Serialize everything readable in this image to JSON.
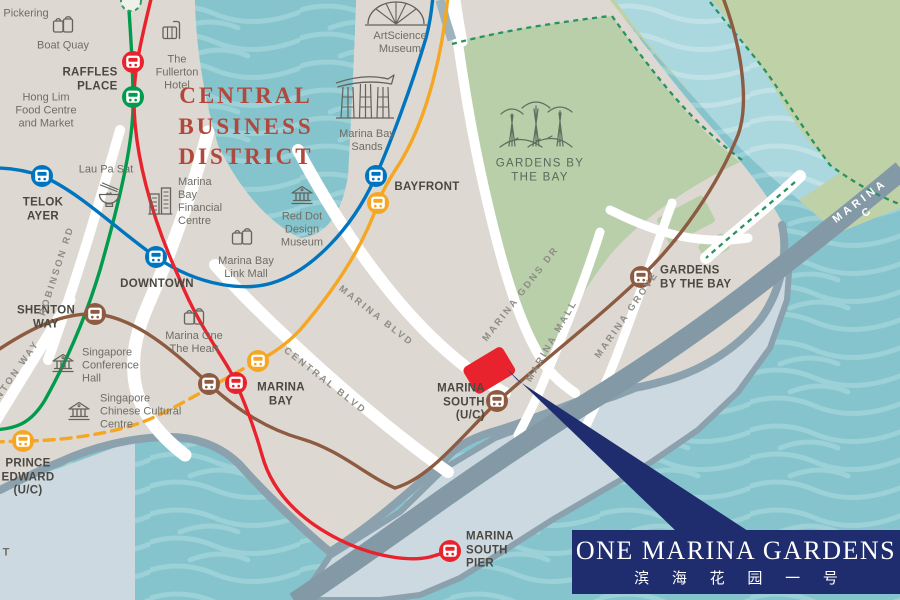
{
  "title": "One Marina Gardens location map",
  "labels": {
    "pickering": "Pickering",
    "boat_quay": "Boat Quay",
    "fullerton": "The\nFullerton\nHotel",
    "hong_lim": "Hong Lim\nFood Centre\nand Market",
    "lau_pa_sat": "Lau Pa Sat",
    "mbfc": "Marina\nBay\nFinancial\nCentre",
    "red_dot": "Red Dot\nDesign\nMuseum",
    "link_mall": "Marina Bay\nLink Mall",
    "artscience": "ArtScience\nMuseum",
    "mbs": "Marina Bay\nSands",
    "gardens_park": "GARDENS BY\nTHE BAY",
    "conference_hall": "Singapore\nConference\nHall",
    "chinese_cultural": "Singapore\nChinese Cultural\nCentre",
    "marina_one": "Marina One\nThe Heart",
    "cbd": "CENTRAL\nBUSINESS\nDISTRICT",
    "fragment_t": "T"
  },
  "stations": {
    "raffles_place": "RAFFLES\nPLACE",
    "telok_ayer": "TELOK\nAYER",
    "downtown": "DOWNTOWN",
    "shenton_way": "SHENTON\nWAY",
    "marina_bay": "MARINA\nBAY",
    "bayfront": "BAYFRONT",
    "prince_edward": "PRINCE\nEDWARD\n(U/C)",
    "gardens_by_the_bay": "GARDENS\nBY THE BAY",
    "marina_south": "MARINA\nSOUTH\n(U/C)",
    "marina_south_pier": "MARINA\nSOUTH\nPIER"
  },
  "roads": {
    "robinson": "ROBINSON RD",
    "shenton": "SHENTON WAY",
    "central_blvd": "CENTRAL BLVD",
    "marina_blvd": "MARINA BLVD",
    "marina_gdns_dr": "MARINA GDNS DR",
    "marina_mall": "MARINA MALL",
    "marina_grove": "MARINA GROVE",
    "marina_coastal": "MARINA C"
  },
  "banner": {
    "title": "ONE MARINA GARDENS",
    "subtitle_cn": "滨 海 花 园 一 号"
  },
  "mrt_lines": [
    {
      "name": "north-south-line",
      "color": "#e8232d"
    },
    {
      "name": "east-west-line",
      "color": "#009b4d"
    },
    {
      "name": "downtown-line",
      "color": "#0075bf"
    },
    {
      "name": "circle-line",
      "color": "#f5a623"
    },
    {
      "name": "thomson-east-coast-line",
      "color": "#8d5b41"
    }
  ],
  "colors": {
    "water": "#85c4cd",
    "water_wave": "#9bd1d7",
    "channel": "#abd7de",
    "land": "#ddd8d1",
    "park": "#b8cfaa",
    "park_northeast": "#bfd1a6",
    "pier": "#ccd9e0",
    "shore": "#8ba1ad",
    "expressway": "#8399a6",
    "cbd_text": "#b2473c",
    "banner_navy": "#1f2d6e",
    "site_red": "#e8232d"
  },
  "icons": [
    "shopping-bags-icon",
    "luggage-icon",
    "noodle-bowl-icon",
    "office-towers-icon",
    "museum-icon",
    "marina-bay-sands-icon",
    "artscience-dome-icon",
    "supertrees-icon",
    "train-icon"
  ]
}
